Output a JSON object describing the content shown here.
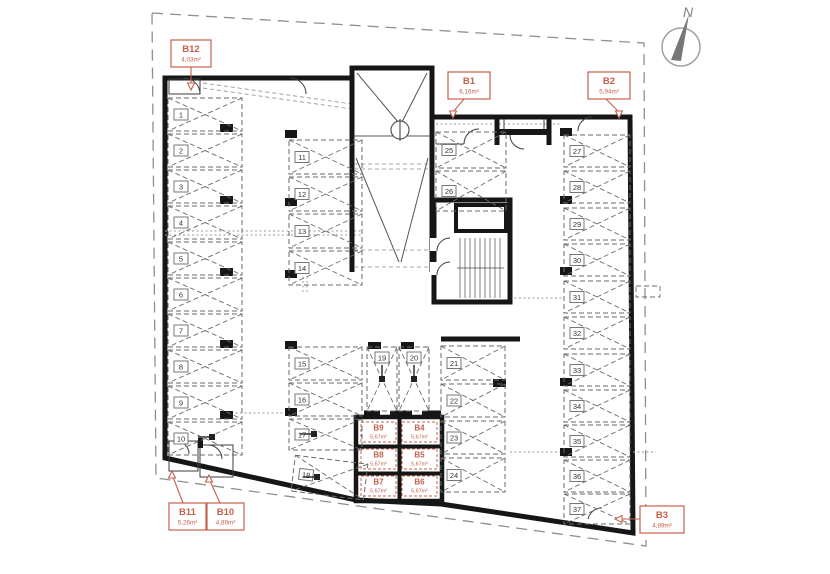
{
  "plan": {
    "north_label": "N",
    "colors": {
      "accent": "#c4614c",
      "wall": "#161616",
      "drawing_line": "#6a6a6a",
      "muted": "#9a9a9a",
      "background": "#ffffff"
    },
    "rooms": [
      {
        "id": "B1",
        "area": "6,16m²"
      },
      {
        "id": "B2",
        "area": "5,94m²"
      },
      {
        "id": "B3",
        "area": "4,89m²"
      },
      {
        "id": "B4",
        "area": "5,67m²"
      },
      {
        "id": "B5",
        "area": "5,67m²"
      },
      {
        "id": "B6",
        "area": "5,67m²"
      },
      {
        "id": "B7",
        "area": "5,67m²"
      },
      {
        "id": "B8",
        "area": "5,67m²"
      },
      {
        "id": "B9",
        "area": "5,67m²"
      },
      {
        "id": "B10",
        "area": "4,89m²"
      },
      {
        "id": "B11",
        "area": "5,26m²"
      },
      {
        "id": "B12",
        "area": "4,03m²"
      }
    ],
    "parking_spots": [
      "1",
      "2",
      "3",
      "4",
      "5",
      "6",
      "7",
      "8",
      "9",
      "10",
      "11",
      "12",
      "13",
      "14",
      "15",
      "16",
      "17",
      "18",
      "19",
      "20",
      "21",
      "22",
      "23",
      "24",
      "25",
      "26",
      "27",
      "28",
      "29",
      "30",
      "31",
      "32",
      "33",
      "34",
      "35",
      "36",
      "37"
    ]
  }
}
